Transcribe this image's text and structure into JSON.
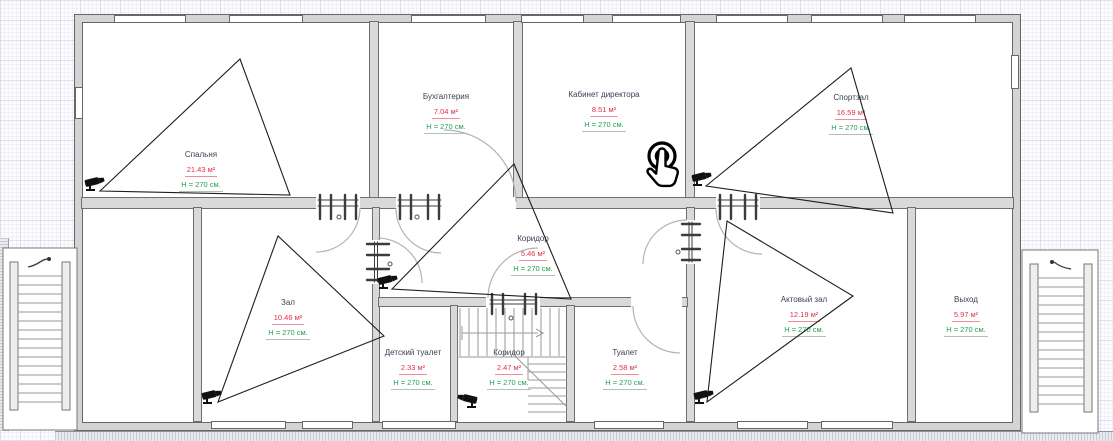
{
  "floor_plan": {
    "rooms": [
      {
        "name": "Спальня",
        "area": "21.43 м²",
        "height": "H = 270 см."
      },
      {
        "name": "Бухгалтерия",
        "area": "7.04 м²",
        "height": "H = 270 см."
      },
      {
        "name": "Кабинет директора",
        "area": "8.51 м²",
        "height": "H = 270 см."
      },
      {
        "name": "Спортзал",
        "area": "16.59 м²",
        "height": "H = 270 см."
      },
      {
        "name": "Зал",
        "area": "10.46 м²",
        "height": "H = 270 см."
      },
      {
        "name": "Коридор",
        "area": "5.46 м²",
        "height": "H = 270 см."
      },
      {
        "name": "Актовый зал",
        "area": "12.19 м²",
        "height": "H = 270 см."
      },
      {
        "name": "Выход",
        "area": "5.97 м²",
        "height": "H = 270 см."
      },
      {
        "name": "Детский туалет",
        "area": "2.33 м²",
        "height": "H = 270 см."
      },
      {
        "name": "Коридор",
        "area": "2.47 м²",
        "height": "H = 270 см."
      },
      {
        "name": "Туалет",
        "area": "2.58 м²",
        "height": "H = 270 см."
      }
    ],
    "devices": {
      "cctv_camera_count": 6,
      "camera_icon": "cctv-camera-icon",
      "tap_icon": "tap-hand-icon",
      "view_cones": 5
    },
    "structures": {
      "exterior_staircases": 2,
      "interior_staircase": 1,
      "stairs_arrow_icon": "curved-direction-arrow"
    },
    "colors": {
      "room_name": "#3c3c58",
      "room_area": "#e03048",
      "room_height": "#23a04e",
      "wall_fill": "#d9d9d9",
      "wall_edge": "#6f6f6f",
      "camera": "#111111",
      "view_cone": "#1d1d1d"
    }
  }
}
